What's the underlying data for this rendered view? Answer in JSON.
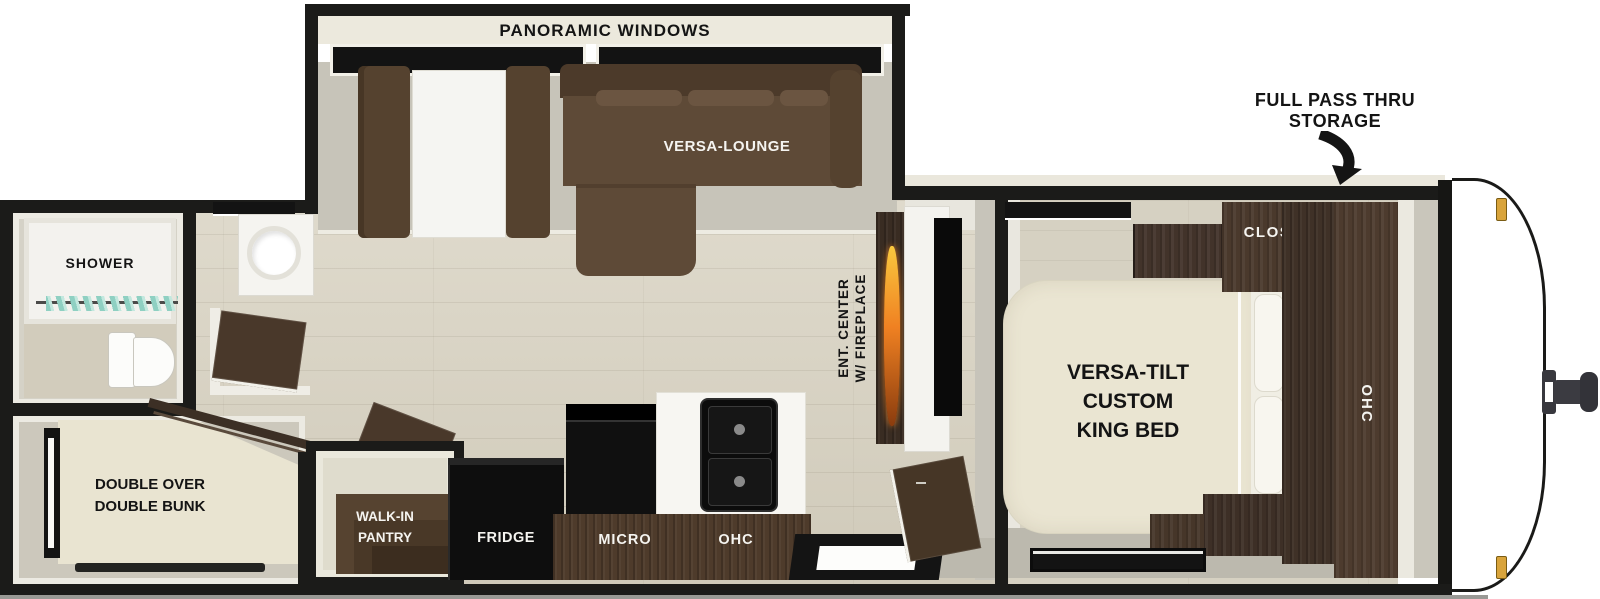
{
  "floorplan": {
    "title": "travel trailer floor plan",
    "labels": {
      "panoramic_windows": "PANORAMIC WINDOWS",
      "versa_lounge": "VERSA-LOUNGE",
      "full_pass_thru_line1": "FULL PASS THRU",
      "full_pass_thru_line2": "STORAGE",
      "closet": "CLOSET",
      "ohc_bedroom": "OHC",
      "king_bed_line1": "VERSA-TILT",
      "king_bed_line2": "CUSTOM",
      "king_bed_line3": "KING BED",
      "ent_center_line1": "ENT. CENTER",
      "ent_center_line2": "W/ FIREPLACE",
      "shower": "SHOWER",
      "bunk_line1": "DOUBLE OVER",
      "bunk_line2": "DOUBLE BUNK",
      "pantry_line1": "WALK-IN",
      "pantry_line2": "PANTRY",
      "fridge": "FRIDGE",
      "micro": "MICRO",
      "ohc_kitchen": "OHC"
    },
    "colors": {
      "wall_outline": "#1b1b19",
      "exterior_white": "#ffffff",
      "outer_wall_cream": "#eae7dc",
      "wood_floor": "#d8d2c1",
      "slideout_floor": "#c7c4b9",
      "gray_floor": "#bcb9ae",
      "sofa_brown": "#5e4a37",
      "dark_wood_cabinet": "#46362a",
      "mattress_cream": "#e9e4d1",
      "appliance_black": "#0e0e0e",
      "counter_white": "#f7f6f2",
      "curtain_teal": "#8fd0c2",
      "flame_orange": "#f08122",
      "marker_light_gold": "#d9a43b",
      "hitch_gray": "#3b3b41"
    }
  }
}
